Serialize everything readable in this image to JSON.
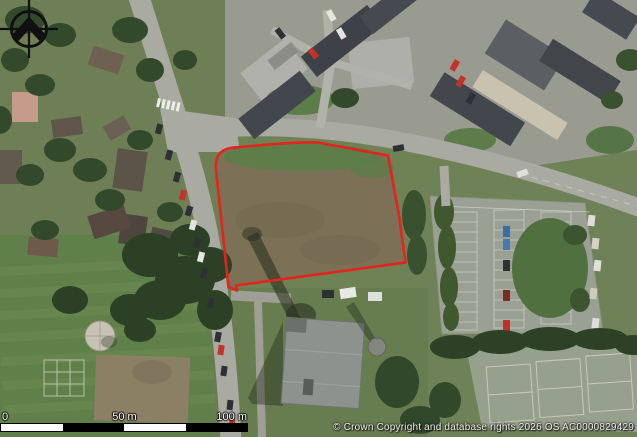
{
  "map": {
    "type": "aerial-photograph",
    "description": "Aerial photo of a town road junction with a development site outlined in red; housing estate above, car park and sports courts right, playing field and round structure lower left, large flat-roofed building below the site",
    "site_outline_color": "#e4231d",
    "site_outline_path": "M228.5,287 L216,170 Q214,149 234,147.5 L252,146 Q300,141.5 318,142.5 L388,155.5 L399,215 L405.5,262.5 L236,285.5 L237,290.5 Z"
  },
  "scale_bar": {
    "labels": [
      "0",
      "50 m",
      "100 m"
    ]
  },
  "attribution": {
    "text": "© Crown Copyright and database rights 2026 OS AC0000829429"
  },
  "icons": {
    "compass": "north-compass-crosshair"
  }
}
